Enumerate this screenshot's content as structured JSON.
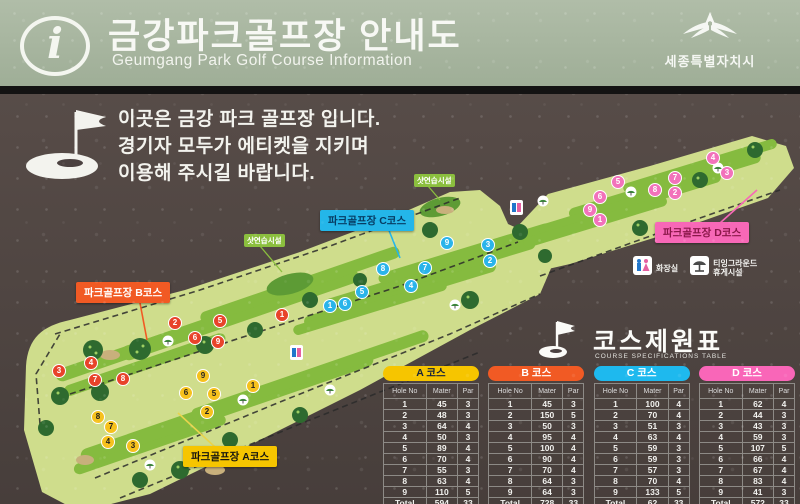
{
  "header": {
    "info_icon": "i",
    "title": "금강파크골프장 안내도",
    "subtitle": "Geumgang Park Golf Course Information",
    "logo_text": "세종특별자치시"
  },
  "notice": {
    "lines": [
      "이곳은 금강 파크 골프장 입니다.",
      "경기자 모두가 에티켓을 지키며",
      "이용해 주시길 바랍니다."
    ]
  },
  "map": {
    "course_labels": [
      {
        "id": "A",
        "text": "파크골프장 A코스",
        "bg": "#f6c500",
        "fg": "#17170f",
        "x": 183,
        "y": 352
      },
      {
        "id": "B",
        "text": "파크골프장 B코스",
        "bg": "#f15a24",
        "fg": "#ffffff",
        "x": 76,
        "y": 188
      },
      {
        "id": "C",
        "text": "파크골프장 C코스",
        "bg": "#24b6e9",
        "fg": "#073c63",
        "x": 320,
        "y": 116
      },
      {
        "id": "D",
        "text": "파크골프장 D코스",
        "bg": "#f768b7",
        "fg": "#8a1749",
        "x": 655,
        "y": 128
      }
    ],
    "facility_labels": [
      {
        "text": "샷연습시설",
        "x": 244,
        "y": 140
      },
      {
        "text": "샷연습시설",
        "x": 414,
        "y": 80
      }
    ],
    "legend": [
      {
        "icon": "restroom-icon",
        "lines": [
          "화장실"
        ]
      },
      {
        "icon": "shelter-icon",
        "lines": [
          "티잉그라운드",
          "휴게시설"
        ]
      }
    ],
    "hole_markers": [
      {
        "course": "A",
        "bg": "#f6c11d",
        "fg": "#1d1d1d",
        "points": [
          [
            1,
            253,
            292
          ],
          [
            2,
            207,
            318
          ],
          [
            3,
            133,
            352
          ],
          [
            4,
            108,
            348
          ],
          [
            5,
            214,
            300
          ],
          [
            6,
            186,
            299
          ],
          [
            7,
            111,
            333
          ],
          [
            8,
            98,
            323
          ],
          [
            9,
            203,
            282
          ]
        ]
      },
      {
        "course": "B",
        "bg": "#e8432a",
        "fg": "#ffffff",
        "points": [
          [
            1,
            282,
            221
          ],
          [
            2,
            175,
            229
          ],
          [
            3,
            59,
            277
          ],
          [
            4,
            91,
            269
          ],
          [
            5,
            220,
            227
          ],
          [
            6,
            195,
            244
          ],
          [
            7,
            95,
            286
          ],
          [
            8,
            123,
            285
          ],
          [
            9,
            218,
            248
          ]
        ]
      },
      {
        "course": "C",
        "bg": "#2ab4ea",
        "fg": "#ffffff",
        "points": [
          [
            1,
            330,
            212
          ],
          [
            2,
            490,
            167
          ],
          [
            3,
            488,
            151
          ],
          [
            4,
            411,
            192
          ],
          [
            5,
            362,
            198
          ],
          [
            6,
            345,
            210
          ],
          [
            7,
            425,
            174
          ],
          [
            8,
            383,
            175
          ],
          [
            9,
            447,
            149
          ]
        ]
      },
      {
        "course": "D",
        "bg": "#f272bb",
        "fg": "#ffffff",
        "points": [
          [
            1,
            600,
            126
          ],
          [
            2,
            675,
            99
          ],
          [
            3,
            727,
            79
          ],
          [
            4,
            713,
            64
          ],
          [
            5,
            618,
            88
          ],
          [
            6,
            600,
            103
          ],
          [
            7,
            675,
            84
          ],
          [
            8,
            655,
            96
          ],
          [
            9,
            590,
            116
          ]
        ]
      }
    ]
  },
  "table": {
    "title": "코스제원표",
    "subtitle": "COURSE SPECIFICATIONS TABLE",
    "columns": [
      "Hole No",
      "Mater",
      "Par"
    ],
    "total_label": "Total",
    "courses": [
      {
        "name": "A 코스",
        "bg": "#f6c500",
        "fg": "#14223c",
        "rows": [
          [
            1,
            45,
            3
          ],
          [
            2,
            48,
            3
          ],
          [
            3,
            64,
            4
          ],
          [
            4,
            50,
            3
          ],
          [
            5,
            89,
            4
          ],
          [
            6,
            70,
            4
          ],
          [
            7,
            55,
            3
          ],
          [
            8,
            63,
            4
          ],
          [
            9,
            110,
            5
          ]
        ],
        "total": [
          "594",
          "33"
        ]
      },
      {
        "name": "B 코스",
        "bg": "#f15a24",
        "fg": "#ffffff",
        "rows": [
          [
            1,
            45,
            3
          ],
          [
            2,
            150,
            5
          ],
          [
            3,
            50,
            3
          ],
          [
            4,
            95,
            4
          ],
          [
            5,
            100,
            4
          ],
          [
            6,
            90,
            4
          ],
          [
            7,
            70,
            4
          ],
          [
            8,
            64,
            3
          ],
          [
            9,
            64,
            3
          ]
        ],
        "total": [
          "728",
          "33"
        ]
      },
      {
        "name": "C 코스",
        "bg": "#1eb9ee",
        "fg": "#ffffff",
        "rows": [
          [
            1,
            100,
            4
          ],
          [
            2,
            70,
            4
          ],
          [
            3,
            51,
            3
          ],
          [
            4,
            63,
            4
          ],
          [
            5,
            59,
            3
          ],
          [
            6,
            59,
            3
          ],
          [
            7,
            57,
            3
          ],
          [
            8,
            70,
            4
          ],
          [
            9,
            133,
            5
          ]
        ],
        "total": [
          "62",
          "33"
        ]
      },
      {
        "name": "D 코스",
        "bg": "#f966b8",
        "fg": "#ffffff",
        "rows": [
          [
            1,
            62,
            4
          ],
          [
            2,
            44,
            3
          ],
          [
            3,
            43,
            3
          ],
          [
            4,
            59,
            3
          ],
          [
            5,
            107,
            5
          ],
          [
            6,
            66,
            4
          ],
          [
            7,
            67,
            4
          ],
          [
            8,
            83,
            4
          ],
          [
            9,
            41,
            3
          ]
        ],
        "total": [
          "572",
          "33"
        ]
      }
    ]
  }
}
